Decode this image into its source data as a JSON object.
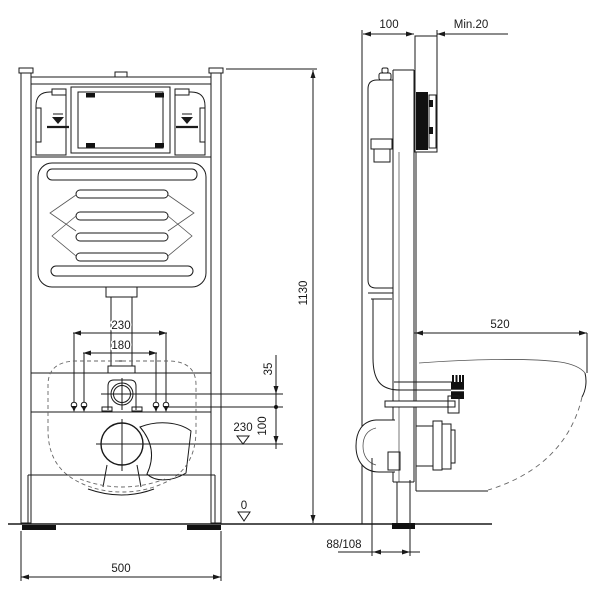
{
  "title": "Concealed WC cistern mounting frame - installation drawing",
  "labels": {
    "front": {
      "outer_fixing_spacing": "230",
      "inner_fixing_spacing": "180",
      "flush_pipe_offset": "35",
      "fixing_to_outlet": "100",
      "outlet_height": "230",
      "floor_level": "0",
      "frame_width": "500"
    },
    "side": {
      "frame_depth": "100",
      "min_finished_wall": "Min.20",
      "frame_height": "1130",
      "bowl_projection": "520",
      "outlet_distance": "88/108"
    }
  }
}
